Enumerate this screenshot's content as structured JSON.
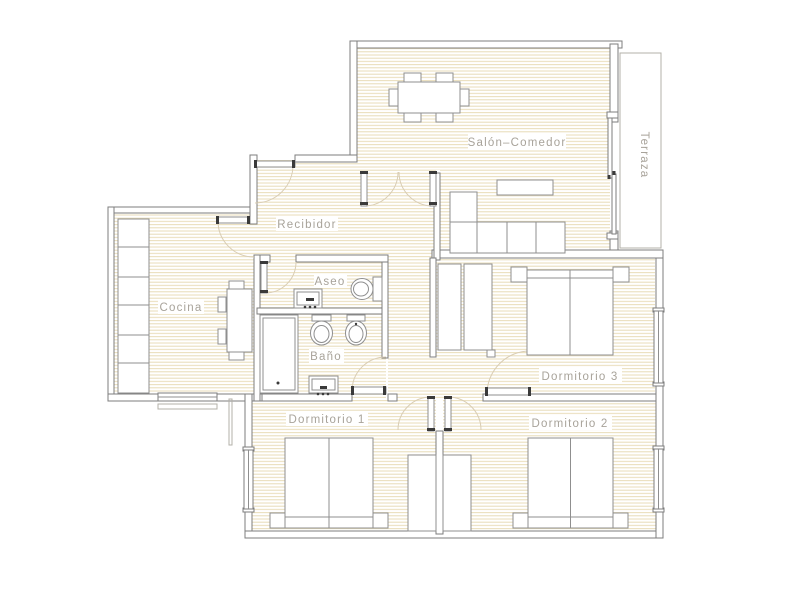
{
  "rooms": {
    "salon": {
      "label": "Salón–Comedor"
    },
    "terraza": {
      "label": "Terraza"
    },
    "recibidor": {
      "label": "Recibidor"
    },
    "cocina": {
      "label": "Cocina"
    },
    "aseo": {
      "label": "Aseo"
    },
    "bano": {
      "label": "Baño"
    },
    "dormitorio1": {
      "label": "Dormitorio 1"
    },
    "dormitorio2": {
      "label": "Dormitorio 2"
    },
    "dormitorio3": {
      "label": "Dormitorio 3"
    }
  },
  "inventory": {
    "salon": [
      "dining-table",
      "six-chairs",
      "corner-sofa",
      "tv-bench",
      "sliding-door-to-terrace",
      "double-swing-door"
    ],
    "terraza": [
      "open-balcony"
    ],
    "recibidor": [
      "entry-door"
    ],
    "cocina": [
      "counter-run",
      "table",
      "four-chairs",
      "window"
    ],
    "aseo": [
      "washbasin",
      "toilet"
    ],
    "bano": [
      "shower",
      "toilet",
      "bidet",
      "washbasin"
    ],
    "dormitorio1": [
      "double-bed",
      "two-nightstands",
      "wardrobe",
      "window"
    ],
    "dormitorio2": [
      "double-bed",
      "two-nightstands",
      "wardrobe",
      "window"
    ],
    "dormitorio3": [
      "double-bed",
      "two-nightstands",
      "wardrobe",
      "window"
    ]
  },
  "colors": {
    "floor_hatch": "#e8dcb8",
    "wall_line": "#7d7d7d",
    "furniture_line": "#8f8f8f",
    "label_text": "#a8a39a",
    "door_arc": "#d9cdb4",
    "fixture_dark": "#3a3a3a",
    "thin_line": "#b3b0a8",
    "background": "#ffffff"
  }
}
